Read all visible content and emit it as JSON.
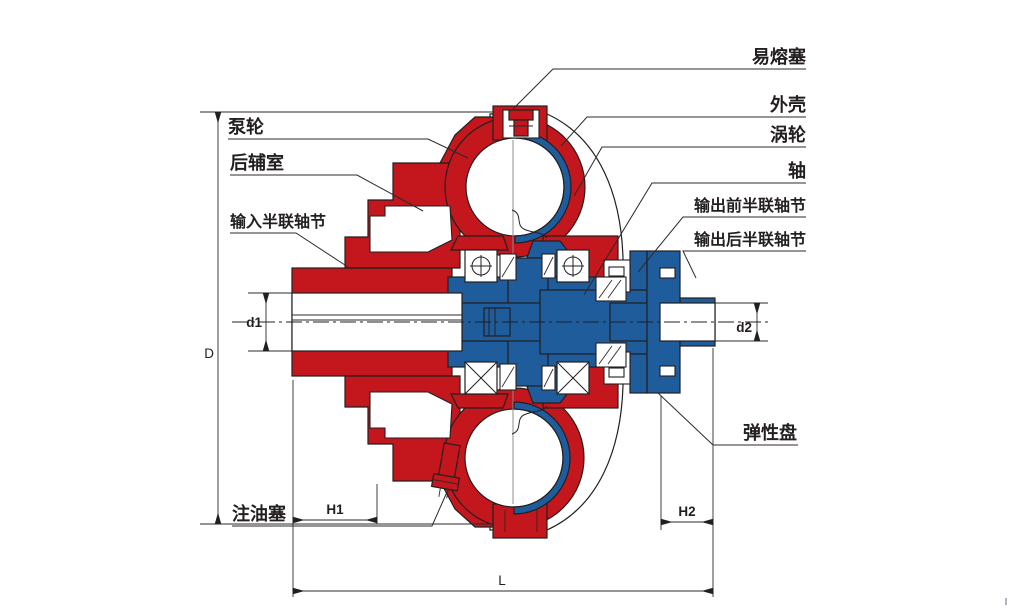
{
  "part_labels": {
    "fusible_plug": "易熔塞",
    "housing": "外壳",
    "turbine": "涡轮",
    "shaft": "轴",
    "output_front_half_coupling": "输出前半联轴节",
    "output_rear_half_coupling": "输出后半联轴节",
    "elastic_disc": "弹性盘",
    "pump_wheel": "泵轮",
    "rear_auxiliary_chamber": "后辅室",
    "input_half_coupling": "输入半联轴节",
    "oil_fill_plug": "注油塞"
  },
  "dimension_labels": {
    "outer_diameter": "D",
    "input_bore": "d1",
    "output_bore": "d2",
    "h1": "H1",
    "h2": "H2",
    "overall_length": "L"
  },
  "colors": {
    "pump_red": "#C3161D",
    "turbine_blue": "#1E5C9B",
    "line_dark": "#231F20",
    "background": "#FFFFFF"
  }
}
